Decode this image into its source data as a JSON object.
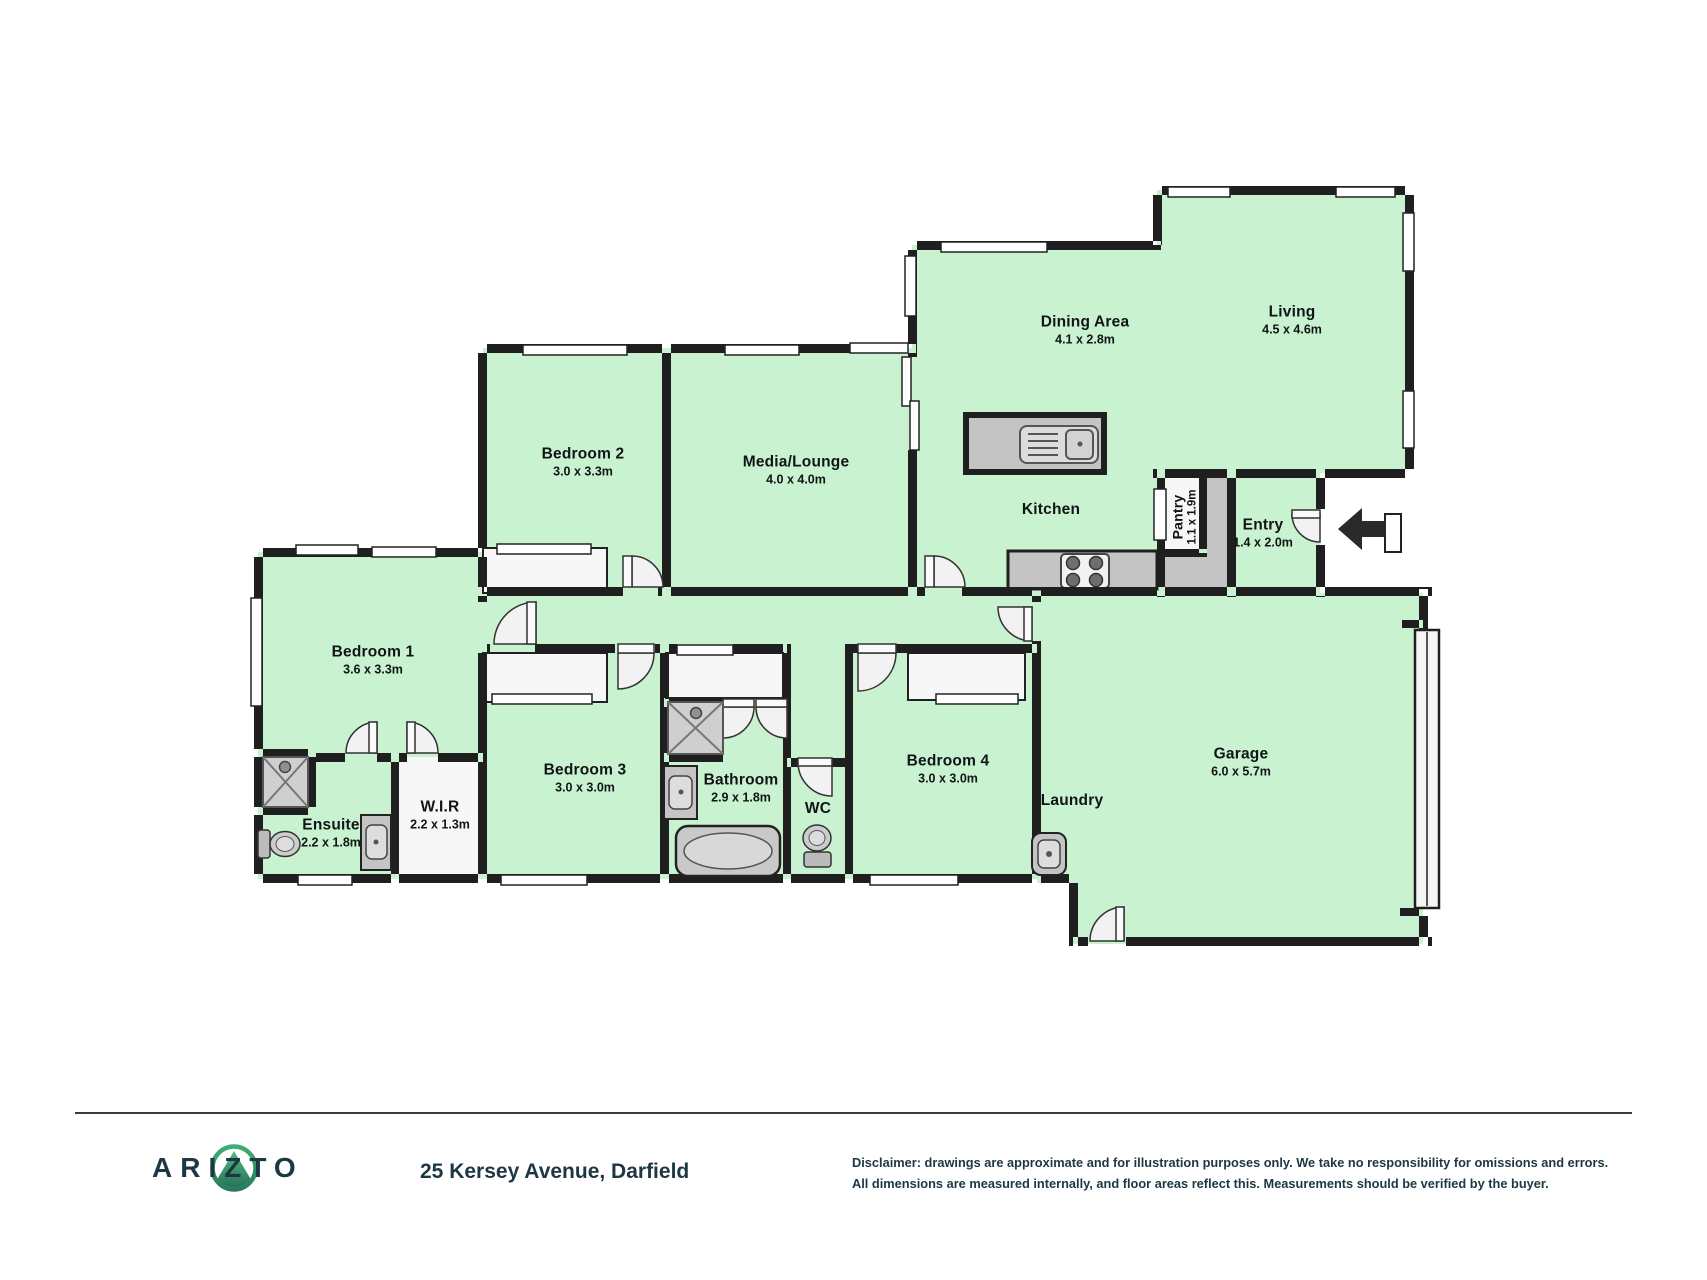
{
  "floorplan": {
    "rooms": [
      {
        "id": "bedroom-2",
        "name": "Bedroom 2",
        "dims": "3.0 x 3.3m",
        "x": 583,
        "y": 462,
        "rotate": 0
      },
      {
        "id": "media-lounge",
        "name": "Media/Lounge",
        "dims": "4.0 x 4.0m",
        "x": 796,
        "y": 470,
        "rotate": 0
      },
      {
        "id": "dining-area",
        "name": "Dining Area",
        "dims": "4.1 x 2.8m",
        "x": 1085,
        "y": 330,
        "rotate": 0
      },
      {
        "id": "living",
        "name": "Living",
        "dims": "4.5 x 4.6m",
        "x": 1292,
        "y": 320,
        "rotate": 0
      },
      {
        "id": "kitchen",
        "name": "Kitchen",
        "dims": "",
        "x": 1051,
        "y": 510,
        "rotate": 0
      },
      {
        "id": "pantry",
        "name": "Pantry",
        "dims": "1.1 x 1.9m",
        "x": 1184,
        "y": 517,
        "rotate": -90
      },
      {
        "id": "entry",
        "name": "Entry",
        "dims": "1.4 x 2.0m",
        "x": 1263,
        "y": 533,
        "rotate": 0
      },
      {
        "id": "garage",
        "name": "Garage",
        "dims": "6.0 x 5.7m",
        "x": 1241,
        "y": 762,
        "rotate": 0
      },
      {
        "id": "laundry",
        "name": "Laundry",
        "dims": "",
        "x": 1072,
        "y": 801,
        "rotate": 0
      },
      {
        "id": "bedroom-4",
        "name": "Bedroom 4",
        "dims": "3.0 x 3.0m",
        "x": 948,
        "y": 769,
        "rotate": 0
      },
      {
        "id": "bedroom-3",
        "name": "Bedroom 3",
        "dims": "3.0 x 3.0m",
        "x": 585,
        "y": 778,
        "rotate": 0
      },
      {
        "id": "bathroom",
        "name": "Bathroom",
        "dims": "2.9 x 1.8m",
        "x": 741,
        "y": 788,
        "rotate": 0
      },
      {
        "id": "wc",
        "name": "WC",
        "dims": "",
        "x": 818,
        "y": 809,
        "rotate": 0
      },
      {
        "id": "bedroom-1",
        "name": "Bedroom 1",
        "dims": "3.6 x 3.3m",
        "x": 373,
        "y": 660,
        "rotate": 0
      },
      {
        "id": "ensuite",
        "name": "Ensuite",
        "dims": "2.2 x 1.8m",
        "x": 331,
        "y": 833,
        "rotate": 0
      },
      {
        "id": "wir",
        "name": "W.I.R",
        "dims": "2.2 x 1.3m",
        "x": 440,
        "y": 815,
        "rotate": 0
      }
    ],
    "colors": {
      "floor": "#c9f2d0",
      "wall": "#1f1f1f",
      "fixture": "#c4c4c4",
      "door": "#f2f2f2",
      "brand_green": "#35a06c",
      "brand_navy": "#1d3743"
    }
  },
  "footer": {
    "brand": "ARIZTO",
    "address": "25 Kersey Avenue, Darfield",
    "disclaimer_line1": "Disclaimer: drawings are approximate and for illustration purposes only. We take no responsibility for omissions and errors.",
    "disclaimer_line2": "All dimensions are measured internally, and floor areas reflect this. Measurements should be verified by the buyer."
  }
}
